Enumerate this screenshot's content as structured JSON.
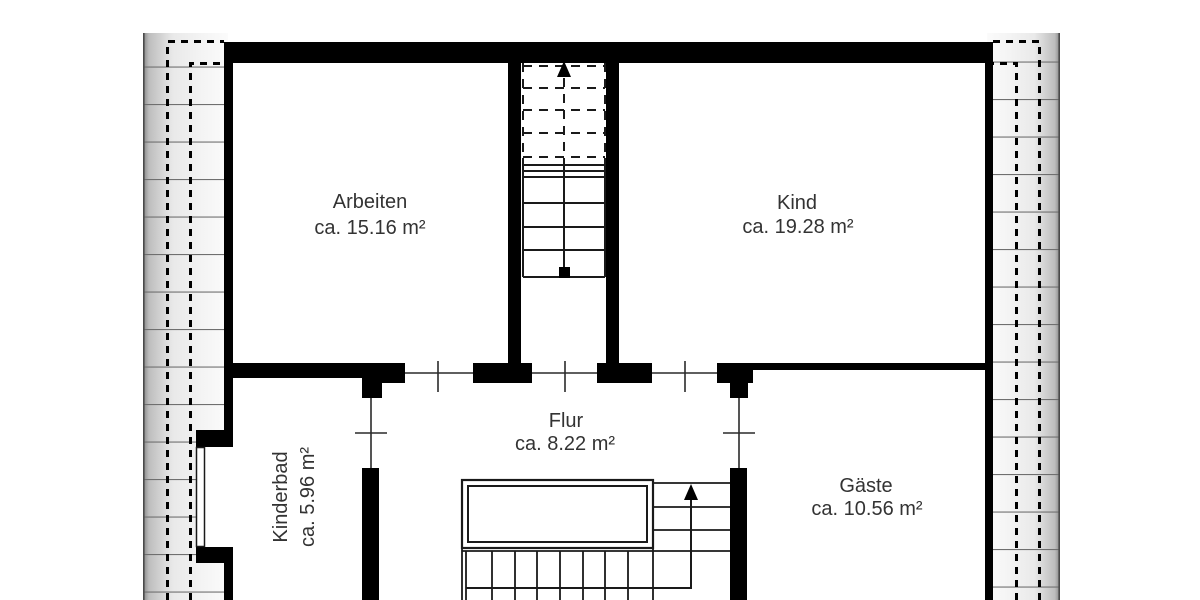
{
  "plan": {
    "type": "floor-plan-upper-storey",
    "rooms": [
      {
        "id": "arbeiten",
        "name": "Arbeiten",
        "area": "ca. 15.16 m²"
      },
      {
        "id": "kind",
        "name": "Kind",
        "area": "ca. 19.28 m²"
      },
      {
        "id": "flur",
        "name": "Flur",
        "area": "ca. 8.22 m²"
      },
      {
        "id": "kinderbad",
        "name": "Kinderbad",
        "area": "ca. 5.96 m²"
      },
      {
        "id": "gaeste",
        "name": "Gäste",
        "area": "ca. 10.56 m²"
      }
    ],
    "colors": {
      "wall": "#000000",
      "background": "#ffffff",
      "roof_band_dark": "#8a8a8a",
      "roof_band_mid": "#e8e8e8",
      "roof_band_light": "#fafafa",
      "course_line": "#6f6f6f",
      "thin_line": "#2a2a2a",
      "text": "#333333"
    }
  }
}
